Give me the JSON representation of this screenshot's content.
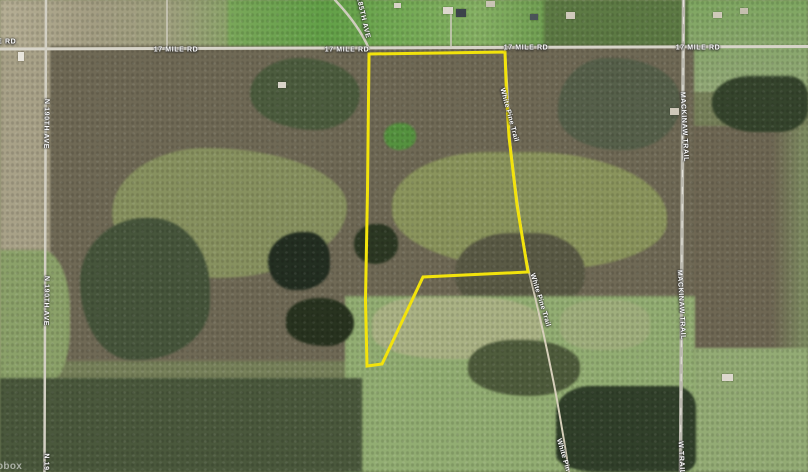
{
  "map": {
    "attribution_partial": "obox",
    "roads": [
      {
        "name": "17 Mile Rd",
        "path": "M0,49 L808,46.5",
        "stroke": "#d7d4c9",
        "width": 3
      },
      {
        "name": "N 190th Ave",
        "path": "M46,0 L44.5,472",
        "stroke": "#d2cfc3",
        "width": 2.5
      },
      {
        "name": "Mackinaw Trail",
        "path": "M683.5,0 L680.5,472",
        "stroke": "#bcbab0",
        "width": 3.5
      },
      {
        "name": "Mackinaw Trail centerline",
        "path": "M683.5,0 L680.5,472",
        "stroke": "#efede4",
        "width": 0.8,
        "dash": "7 10"
      },
      {
        "name": "185th Ave",
        "path": "M335,0 C350,16 362,32 369,49",
        "stroke": "#cfccbe",
        "width": 2.5
      },
      {
        "name": "White Pine Trail",
        "path": "M505,50 C508,95 509,120 510,140 C516,195 522,238 529,272 C537,304 548,352 557,400 C562,428 566,452 569,472",
        "stroke": "#d6cfba",
        "width": 2
      },
      {
        "name": "driveway",
        "path": "M451,8 L451,47",
        "stroke": "#cfccbf",
        "width": 1.5
      },
      {
        "name": "driveway",
        "path": "M167,0 L167,48",
        "stroke": "#cfccbf",
        "width": 1.5
      }
    ],
    "labels": [
      {
        "text": "17 MILE RD",
        "x": -6,
        "y": 42,
        "rot": 0,
        "partial": true
      },
      {
        "text": "17 MILE RD",
        "x": 176,
        "y": 50,
        "rot": 0
      },
      {
        "text": "17 MILE RD",
        "x": 347,
        "y": 50,
        "rot": 0
      },
      {
        "text": "17 MILE RD",
        "x": 526,
        "y": 48,
        "rot": 0
      },
      {
        "text": "17 MILE RD",
        "x": 698,
        "y": 48,
        "rot": 0
      },
      {
        "text": "185TH AVE",
        "x": 363,
        "y": 18,
        "rot": 77
      },
      {
        "text": "N 190TH AVE",
        "x": 46,
        "y": 124,
        "rot": 91
      },
      {
        "text": "N 190TH AVE",
        "x": 46,
        "y": 301,
        "rot": 91
      },
      {
        "text": "N 19",
        "x": 46,
        "y": 462,
        "rot": 91,
        "partial": true
      },
      {
        "text": "MACKINAW TRAIL",
        "x": 684,
        "y": 127,
        "rot": 87
      },
      {
        "text": "MACKINAW TRAIL",
        "x": 681,
        "y": 305,
        "rot": 87
      },
      {
        "text": "W TRAIL",
        "x": 681,
        "y": 458,
        "rot": 87,
        "partial": true
      },
      {
        "text": "White Pine Trail",
        "x": 509,
        "y": 115,
        "rot": 75,
        "minor": true
      },
      {
        "text": "White Pine Trail",
        "x": 540,
        "y": 300,
        "rot": 73,
        "minor": true
      },
      {
        "text": "White Pin",
        "x": 563,
        "y": 455,
        "rot": 74,
        "minor": true,
        "partial": true
      }
    ],
    "parcel_boundary": {
      "color": "#f2e30c",
      "width": 3,
      "closed": true,
      "points": [
        [
          369,
          54
        ],
        [
          505,
          52
        ],
        [
          506.5,
          95
        ],
        [
          509,
          137
        ],
        [
          517,
          205
        ],
        [
          528,
          272
        ],
        [
          423,
          277
        ],
        [
          382,
          364
        ],
        [
          367,
          366
        ],
        [
          365.5,
          300
        ],
        [
          367.5,
          190
        ]
      ]
    },
    "buildings": [
      {
        "x": 443,
        "y": 7,
        "w": 10,
        "h": 7,
        "color": "#ddd8ce"
      },
      {
        "x": 456,
        "y": 9,
        "w": 10,
        "h": 8,
        "color": "#3c434a"
      },
      {
        "x": 486,
        "y": 1,
        "w": 9,
        "h": 6,
        "color": "#c9c3b4"
      },
      {
        "x": 394,
        "y": 3,
        "w": 7,
        "h": 5,
        "color": "#d8d3c8"
      },
      {
        "x": 278,
        "y": 82,
        "w": 8,
        "h": 6,
        "color": "#d8d3c8"
      },
      {
        "x": 670,
        "y": 108,
        "w": 9,
        "h": 7,
        "color": "#cfc9ba"
      },
      {
        "x": 722,
        "y": 374,
        "w": 11,
        "h": 7,
        "color": "#ddd8ce"
      },
      {
        "x": 713,
        "y": 12,
        "w": 9,
        "h": 6,
        "color": "#d0caba"
      },
      {
        "x": 740,
        "y": 8,
        "w": 8,
        "h": 6,
        "color": "#c5bfae"
      },
      {
        "x": 566,
        "y": 12,
        "w": 9,
        "h": 7,
        "color": "#cfc9bb"
      },
      {
        "x": 530,
        "y": 14,
        "w": 8,
        "h": 6,
        "color": "#4a5258"
      },
      {
        "x": 18,
        "y": 52,
        "w": 6,
        "h": 9,
        "color": "#e8e5dc"
      }
    ]
  }
}
